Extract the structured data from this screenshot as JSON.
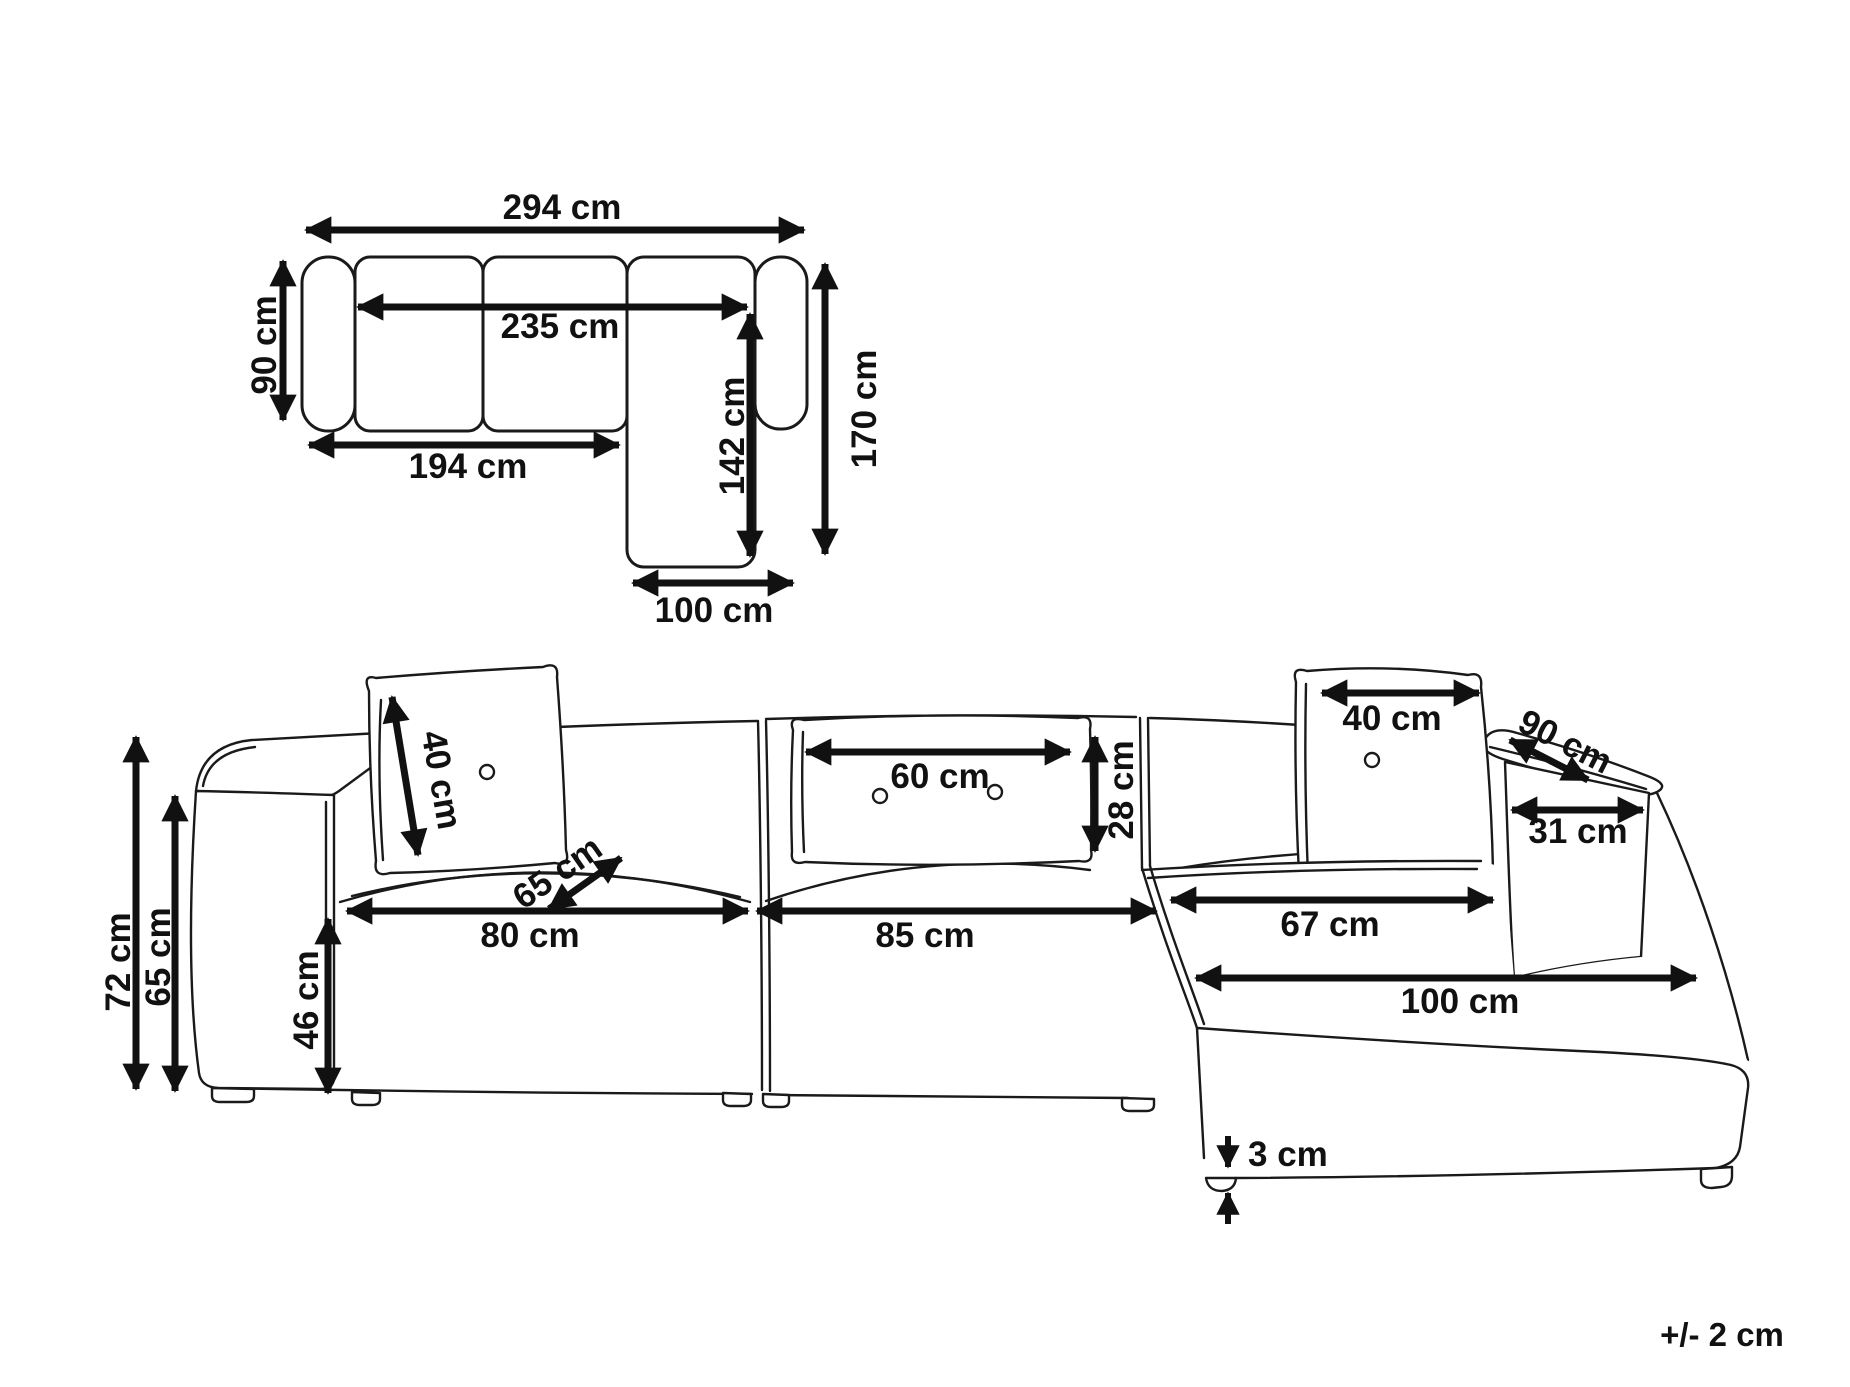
{
  "page": {
    "tolerance_note": "+/- 2 cm"
  },
  "top_view": {
    "dims": {
      "total_width": "294 cm",
      "back_span": "235 cm",
      "depth": "90 cm",
      "left_length": "194 cm",
      "chaise_inner_length": "142 cm",
      "right_depth_total": "170 cm",
      "chaise_width": "100 cm"
    }
  },
  "front_view": {
    "dims": {
      "total_height": "72 cm",
      "armrest_height": "65 cm",
      "left_cushion": "40 cm",
      "seat_diag_depth": "65 cm",
      "left_seat_width": "80 cm",
      "seat_height": "46 cm",
      "center_cushion_width": "60 cm",
      "center_cushion_height": "28 cm",
      "center_seat_width": "85 cm",
      "right_cushion": "40 cm",
      "armrest_diag_depth": "90 cm",
      "armrest_front_width": "31 cm",
      "chaise_seat_width": "67 cm",
      "chaise_front_width": "100 cm",
      "leg_height": "3 cm"
    }
  }
}
